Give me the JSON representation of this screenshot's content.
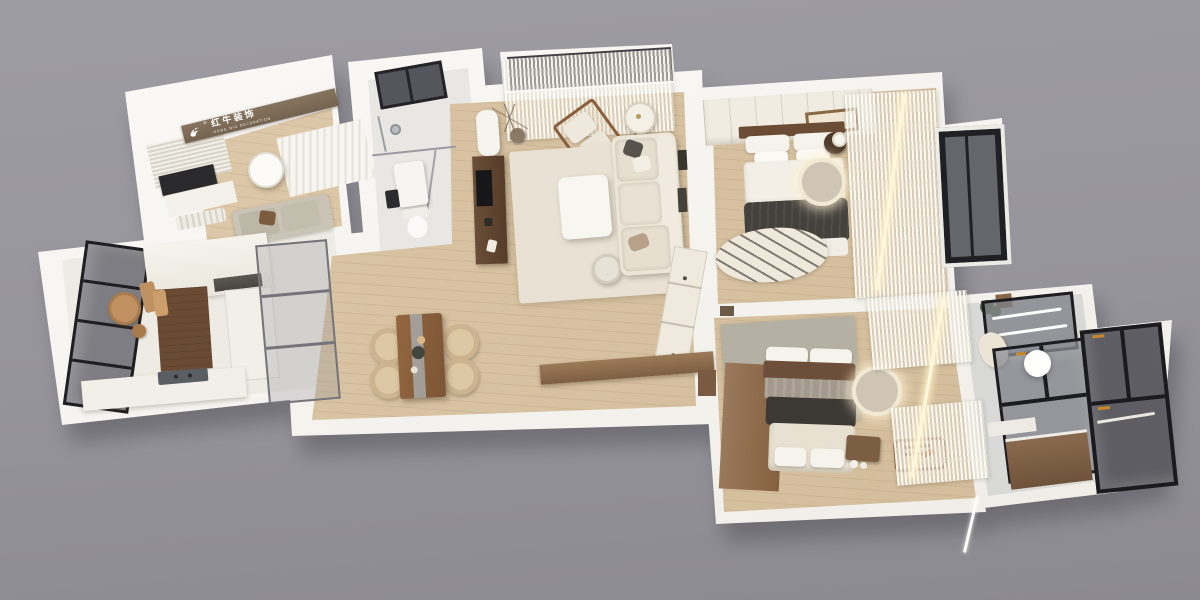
{
  "scene": {
    "type": "3d-floorplan-render",
    "description": "Top-down 3D dollhouse render of a furnished three-bedroom apartment viewed at an angle on a plain gray backdrop",
    "background_color": "#97969c"
  },
  "logo": {
    "brand_cn": "红牛装饰",
    "brand_en": "HONG NIU DECORATION",
    "registered_mark": "®",
    "icon": "bull-logo-icon",
    "band_color": "#7d6a56",
    "text_color": "#ffffff"
  },
  "palette": {
    "wall_white": "#f5f2ec",
    "wood_floor": "#d8c3a3",
    "furniture_walnut": "#7a5b3e",
    "dark_textile": "#44403c",
    "gray_textile": "#a39a8d",
    "brown_textile": "#6d4e3a",
    "sofa_cream": "#ece6da",
    "rug_cream": "#e9e2d4",
    "rug_gray": "#b4b0a3",
    "glass_dark": "#63636a",
    "frame_black": "#1d1d21",
    "curtain_sheer": "#f4f1ea",
    "led_glow": "#fff3d6",
    "plant_green": "#4c683e"
  },
  "rooms": [
    {
      "id": "study",
      "label": "study / multi-purpose room"
    },
    {
      "id": "kitchen",
      "label": "kitchen"
    },
    {
      "id": "bathroom-main",
      "label": "main bathroom"
    },
    {
      "id": "living-room",
      "label": "living room"
    },
    {
      "id": "dining-area",
      "label": "dining area"
    },
    {
      "id": "balcony",
      "label": "balcony with sheer curtains"
    },
    {
      "id": "master-bedroom",
      "label": "master bedroom"
    },
    {
      "id": "second-bedroom",
      "label": "second bedroom"
    },
    {
      "id": "bathroom-ensuite",
      "label": "en-suite bathroom / laundry balcony"
    }
  ]
}
